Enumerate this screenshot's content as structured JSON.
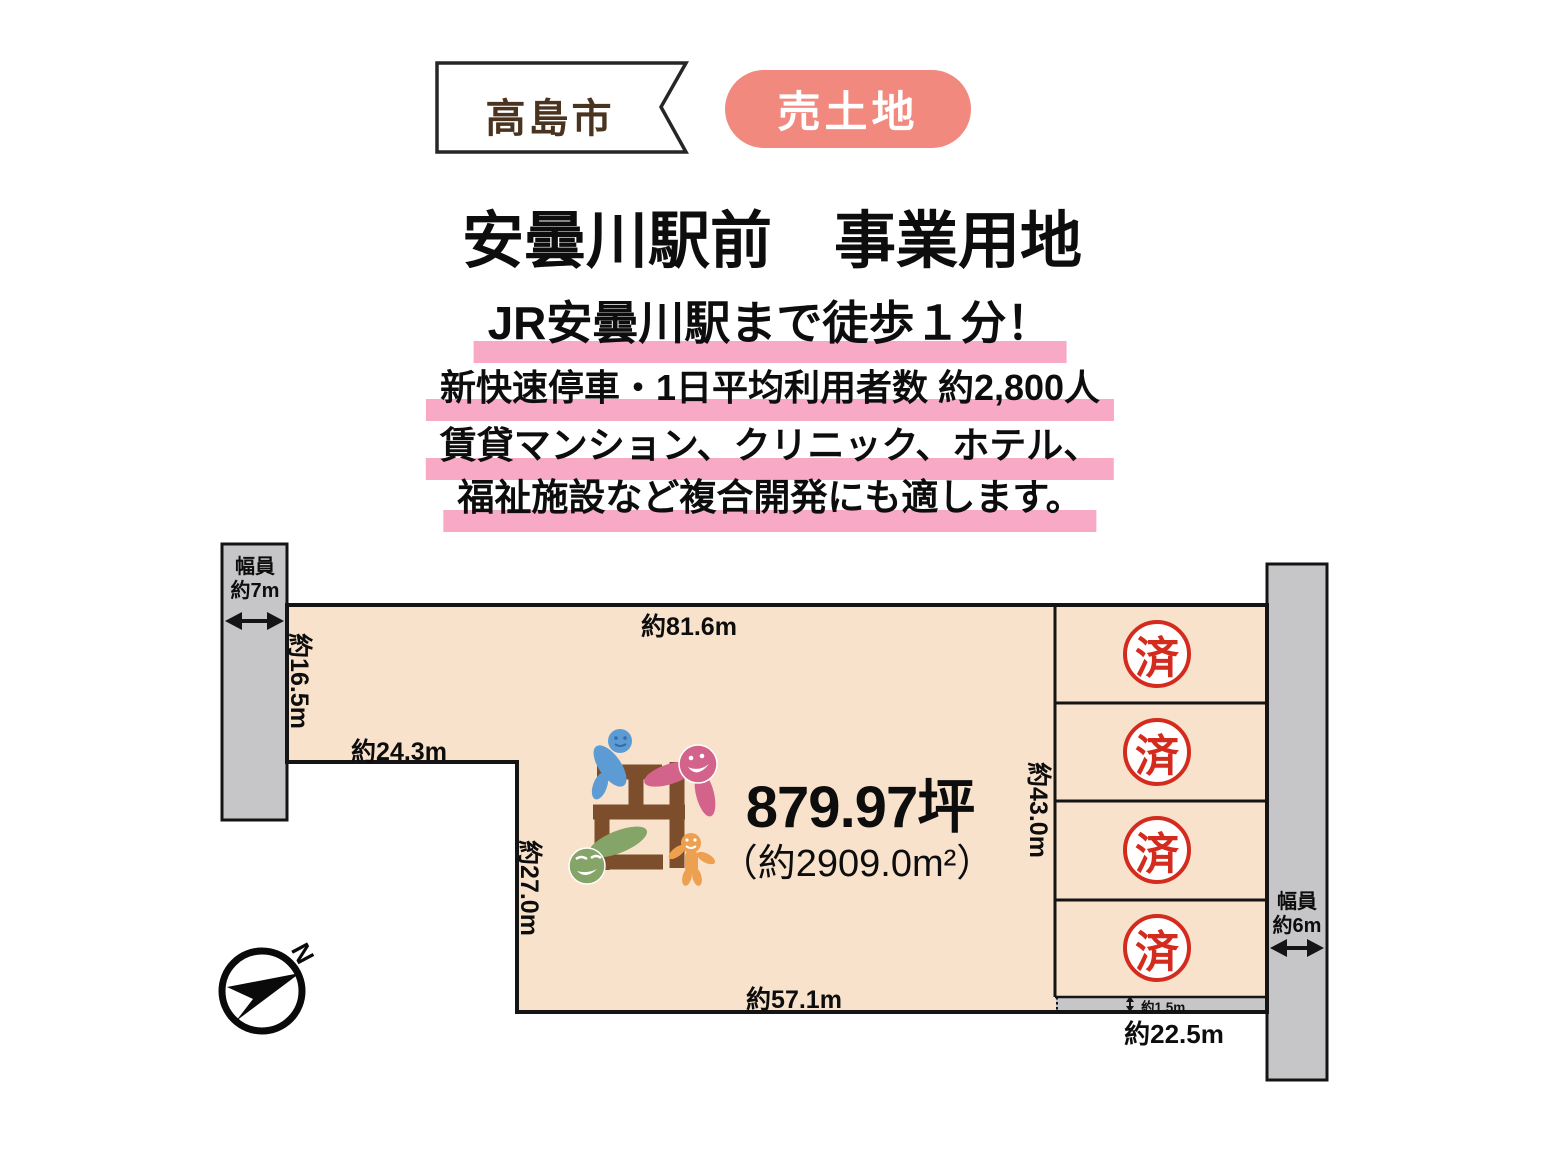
{
  "header": {
    "city_badge": "高島市",
    "sale_badge": "売土地",
    "title": "安曇川駅前　事業用地",
    "catchphrases": [
      "JR安曇川駅まで徒歩１分！",
      "新快速停車・1日平均利用者数 約2,800人",
      "賃貸マンション、クリニック、ホテル、",
      "福祉施設など複合開発にも適します。"
    ]
  },
  "site_plan": {
    "area_main": "879.97坪",
    "area_sub": "（約2909.0m²）",
    "dimensions": {
      "top": "約81.6m",
      "left_upper": "約16.5m",
      "left_step": "約24.3m",
      "left_lower": "約27.0m",
      "bottom": "約57.1m",
      "right_inner": "約43.0m",
      "bottom_right": "約22.5m",
      "alley": "約1.5m"
    },
    "roads": {
      "left": {
        "line1": "幅員",
        "line2": "約7m"
      },
      "right": {
        "line1": "幅員",
        "line2": "約6m"
      }
    },
    "sold_stamp": "済",
    "compass_north": "N"
  },
  "colors": {
    "land_fill": "#F8E2CB",
    "road_fill": "#C6C6C8",
    "badge_pink": "#F2897F",
    "highlight_pink": "#F7A9C6",
    "stamp_red": "#D32B1E",
    "ribbon_text_brown": "#4A341F",
    "logo_brown": "#7C4E2B",
    "outline_black": "#141414"
  }
}
